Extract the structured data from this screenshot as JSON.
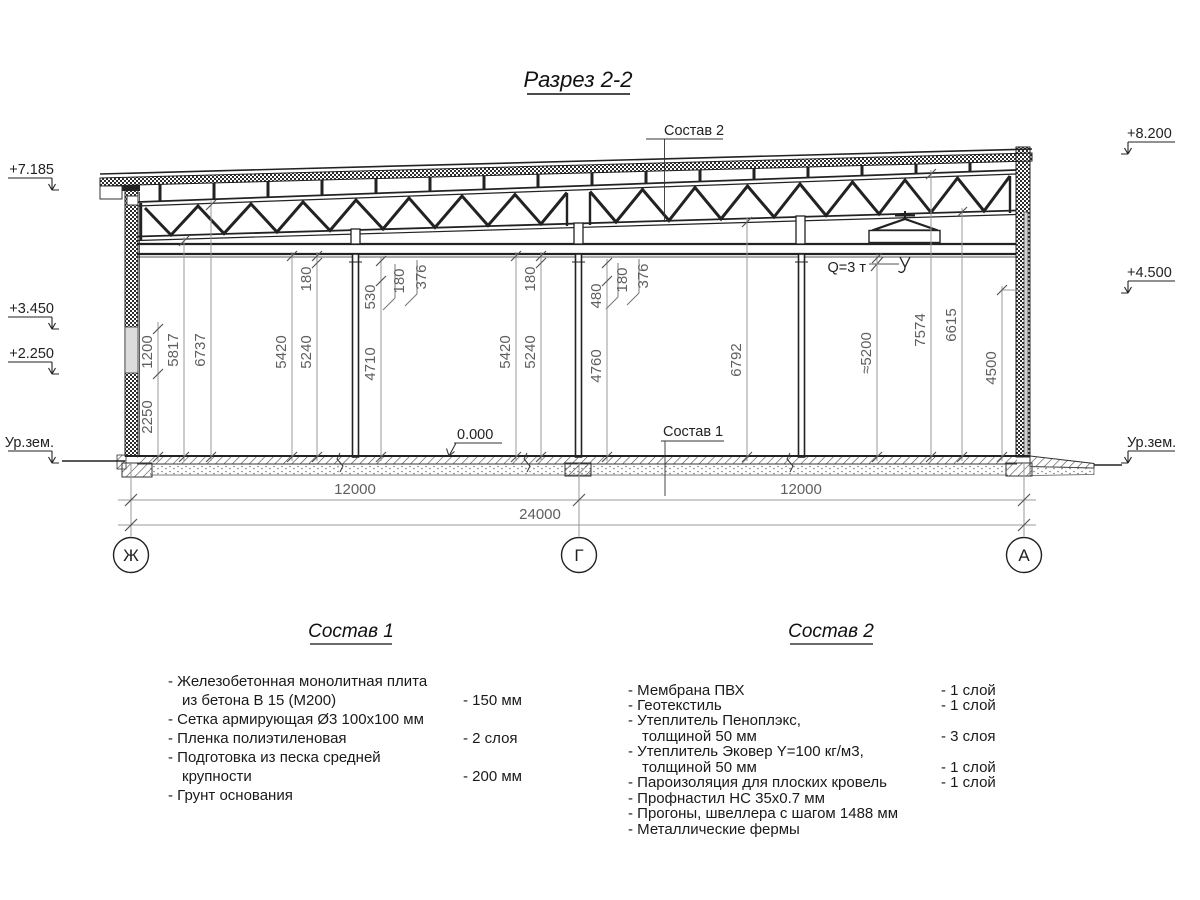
{
  "title": "Разрез 2-2",
  "callouts": {
    "top": "Состав 2",
    "floor": "Состав 1",
    "zero_level": "0.000",
    "crane_capacity": "Q=3 т"
  },
  "elevations": {
    "left": [
      "+7.185",
      "+3.450",
      "+2.250",
      "Ур.зем."
    ],
    "right": [
      "+8.200",
      "+4.500",
      "Ур.зем."
    ]
  },
  "axes": [
    "Ж",
    "Г",
    "А"
  ],
  "dims": {
    "vertical": [
      "1200",
      "2250",
      "5817",
      "6737",
      "5420",
      "5240",
      "180",
      "530",
      "180",
      "376",
      "4710",
      "5420",
      "5240",
      "180",
      "480",
      "180",
      "376",
      "4760",
      "6792",
      "≈5200",
      "7574",
      "6615",
      "4500"
    ],
    "horizontal": [
      "12000",
      "12000",
      "24000"
    ]
  },
  "legend1": {
    "header": "Состав 1",
    "rows": [
      {
        "name": "- Железобетонная  монолитная плита",
        "value": ""
      },
      {
        "name": "из бетона В 15 (М200)",
        "value": "- 150 мм"
      },
      {
        "name": "- Сетка армирующая Ø3 100х100 мм",
        "value": ""
      },
      {
        "name": "- Пленка полиэтиленовая",
        "value": "- 2 слоя"
      },
      {
        "name": "- Подготовка из песка средней",
        "value": ""
      },
      {
        "name": "крупности",
        "value": "- 200 мм"
      },
      {
        "name": "- Грунт основания",
        "value": ""
      }
    ]
  },
  "legend2": {
    "header": "Состав 2",
    "rows": [
      {
        "name": "- Мембрана ПВХ",
        "value": "- 1 слой"
      },
      {
        "name": "- Геотекстиль",
        "value": "- 1 слой"
      },
      {
        "name": "- Утеплитель Пеноплэкс,",
        "value": ""
      },
      {
        "name": "толщиной 50 мм",
        "value": "- 3 слоя"
      },
      {
        "name": "- Утеплитель Эковер Y=100 кг/м3,",
        "value": ""
      },
      {
        "name": "толщиной 50 мм",
        "value": "- 1 слой"
      },
      {
        "name": "- Пароизоляция для плоских кровель",
        "value": "- 1 слой"
      },
      {
        "name": "- Профнастил НС 35х0.7 мм",
        "value": ""
      },
      {
        "name": "- Прогоны, швеллера с шагом 1488 мм",
        "value": ""
      },
      {
        "name": "- Металлические фермы",
        "value": ""
      }
    ]
  }
}
